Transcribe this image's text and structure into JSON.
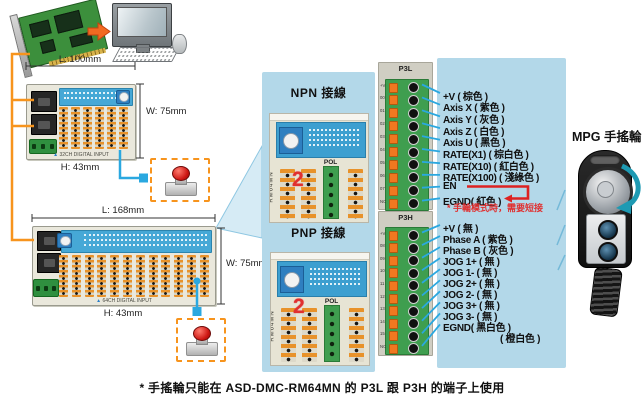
{
  "colors": {
    "panel_blue": "#b3d8e9",
    "wire_blue": "#2aa8e0",
    "wire_orange": "#f7941d",
    "note_red": "#e03030",
    "estop_red": "#cc1511",
    "terminal_orange": "#e8922a",
    "terminal_green": "#3f9e4f",
    "strip_blue": "#46a8d6"
  },
  "modules": {
    "small": {
      "length": "L: 100mm",
      "width": "W: 75mm",
      "height": "H: 43mm",
      "bottom_label": "32CH DIGITAL INPUT"
    },
    "large": {
      "length": "L: 168mm",
      "width": "W: 75mm",
      "height": "H: 43mm",
      "bottom_label": "64CH DIGITAL INPUT"
    }
  },
  "wiring_sections": {
    "npn": {
      "title": "NPN 接線",
      "pol_label": "POL",
      "model_label": "RM64MN",
      "jumper_digit": "2"
    },
    "pnp": {
      "title": "PNP 接線",
      "pol_label": "POL",
      "model_label": "RM64MN",
      "jumper_digit": "2"
    }
  },
  "p3l": {
    "header": "P3L",
    "pins": [
      "+V",
      "00",
      "01",
      "02",
      "03",
      "04",
      "05",
      "06",
      "07",
      "NC"
    ],
    "signals": [
      "+V ( 棕色 )",
      "Axis X ( 紫色 )",
      "Axis Y ( 灰色 )",
      "Axis Z ( 白色 )",
      "Axis U ( 黑色 )",
      "RATE(X1) ( 棕白色 )",
      "RATE(X10) ( 紅白色 )",
      "RATE(X100) ( 淺綠色 )",
      "EN",
      "EGND( 紅色 )"
    ],
    "note": "* 手輪模式時，需要短接"
  },
  "p3h": {
    "header": "P3H",
    "pins": [
      "+V",
      "08",
      "09",
      "10",
      "11",
      "12",
      "13",
      "14",
      "15",
      "NC"
    ],
    "signals": [
      "+V ( 無 )",
      "Phase A ( 紫色 )",
      "Phase B ( 灰色 )",
      "JOG 1+ ( 無 )",
      "JOG 1- ( 無 )",
      "JOG 2+ ( 無 )",
      "JOG 2- ( 無 )",
      "JOG 3+ ( 無 )",
      "JOG 3- ( 無 )",
      "EGND( 黑白色 )",
      "( 橙白色 )"
    ]
  },
  "mpg": {
    "title": "MPG 手搖輪"
  },
  "footer_note": "* 手搖輪只能在 ASD-DMC-RM64MN 的 P3L 跟 P3H 的端子上使用"
}
